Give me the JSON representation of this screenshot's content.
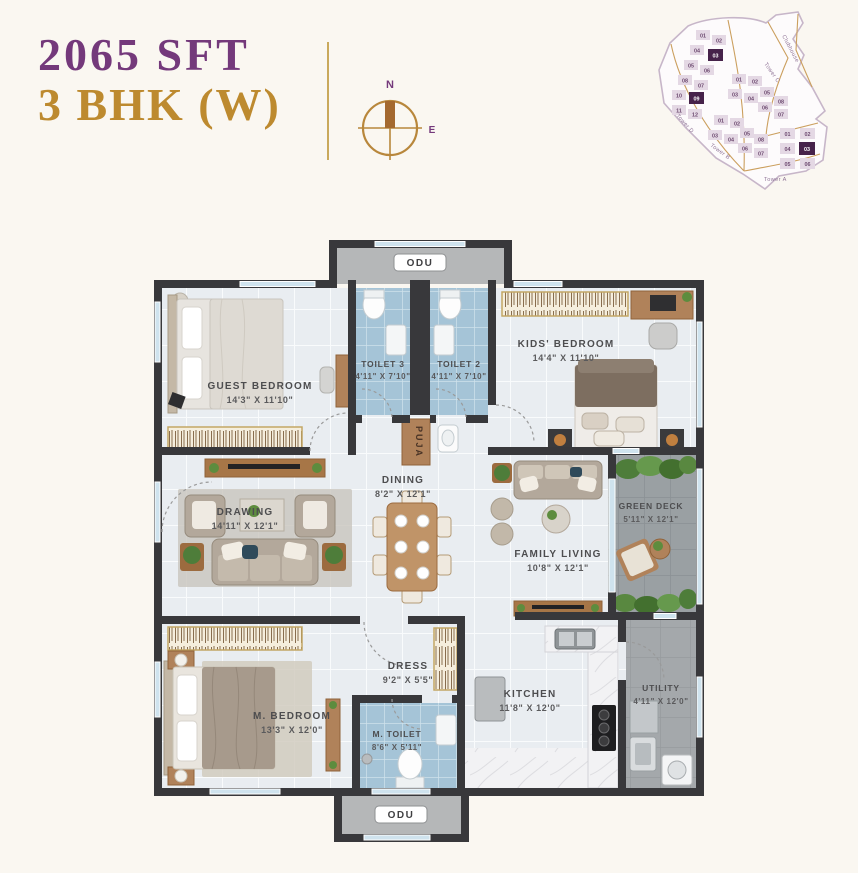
{
  "header": {
    "area": "2065 SFT",
    "unit_type": "3 BHK (W)",
    "accent_purple": "#74397B",
    "accent_gold": "#BD8A2F"
  },
  "compass": {
    "north": "N",
    "east": "E"
  },
  "site_plan": {
    "clubhouse_label": "Clubhouse",
    "towers": [
      {
        "name": "Tower D",
        "units": [
          "01",
          "02",
          "04",
          "03",
          "05",
          "06",
          "08",
          "07",
          "10",
          "09",
          "11",
          "12"
        ],
        "highlighted": [
          "03",
          "09"
        ]
      },
      {
        "name": "Tower C",
        "units": [
          "01",
          "02",
          "03",
          "04",
          "05",
          "08",
          "06",
          "07"
        ],
        "highlighted": []
      },
      {
        "name": "Tower B",
        "units": [
          "01",
          "02",
          "03",
          "04",
          "05",
          "08",
          "06",
          "07"
        ],
        "highlighted": []
      },
      {
        "name": "Tower A",
        "units": [
          "01",
          "02",
          "04",
          "03",
          "05",
          "06"
        ],
        "highlighted": [
          "03"
        ]
      }
    ]
  },
  "floor_plan": {
    "rooms": [
      {
        "name": "ODU",
        "dims": ""
      },
      {
        "name": "GUEST BEDROOM",
        "dims": "14'3\" X 11'10\""
      },
      {
        "name": "TOILET 3",
        "dims": "4'11\" X 7'10\""
      },
      {
        "name": "TOILET 2",
        "dims": "4'11\" X 7'10\""
      },
      {
        "name": "KIDS' BEDROOM",
        "dims": "14'4\" X 11'10\""
      },
      {
        "name": "PUJA",
        "dims": ""
      },
      {
        "name": "DRAWING",
        "dims": "14'11\" X 12'1\""
      },
      {
        "name": "DINING",
        "dims": "8'2\" X 12'1\""
      },
      {
        "name": "FAMILY LIVING",
        "dims": "10'8\" X 12'1\""
      },
      {
        "name": "GREEN DECK",
        "dims": "5'11\" X 12'1\""
      },
      {
        "name": "M. BEDROOM",
        "dims": "13'3\" X 12'0\""
      },
      {
        "name": "DRESS",
        "dims": "9'2\" X 5'5\""
      },
      {
        "name": "M. TOILET",
        "dims": "8'6\" X 5'11\""
      },
      {
        "name": "KITCHEN",
        "dims": "11'8\" X 12'0\""
      },
      {
        "name": "UTILITY",
        "dims": "4'11\" X 12'0\""
      },
      {
        "name": "ODU",
        "dims": ""
      }
    ]
  }
}
